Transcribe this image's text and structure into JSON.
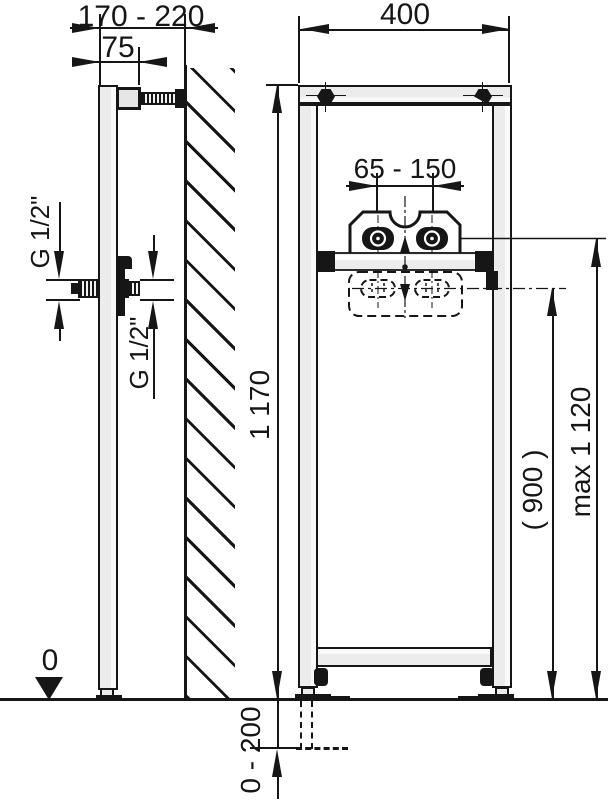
{
  "drawing": {
    "type": "installation-frame-technical-drawing",
    "views": [
      "side-view",
      "front-view"
    ],
    "colors": {
      "line": "#161616",
      "profile_fill": "#ececec",
      "background": "#ffffff"
    },
    "dims": {
      "wall_distance": "170 - 220",
      "bracket_depth": "75",
      "frame_width": "400",
      "tap_spacing": "65 - 150",
      "frame_height": "1 170",
      "alt_height": "( 900 )",
      "max_height": "max 1 120",
      "leg_range": "0 - 200",
      "floor_level": "0",
      "thread_front": "G 1/2\"",
      "thread_rear": "G 1/2\""
    }
  }
}
